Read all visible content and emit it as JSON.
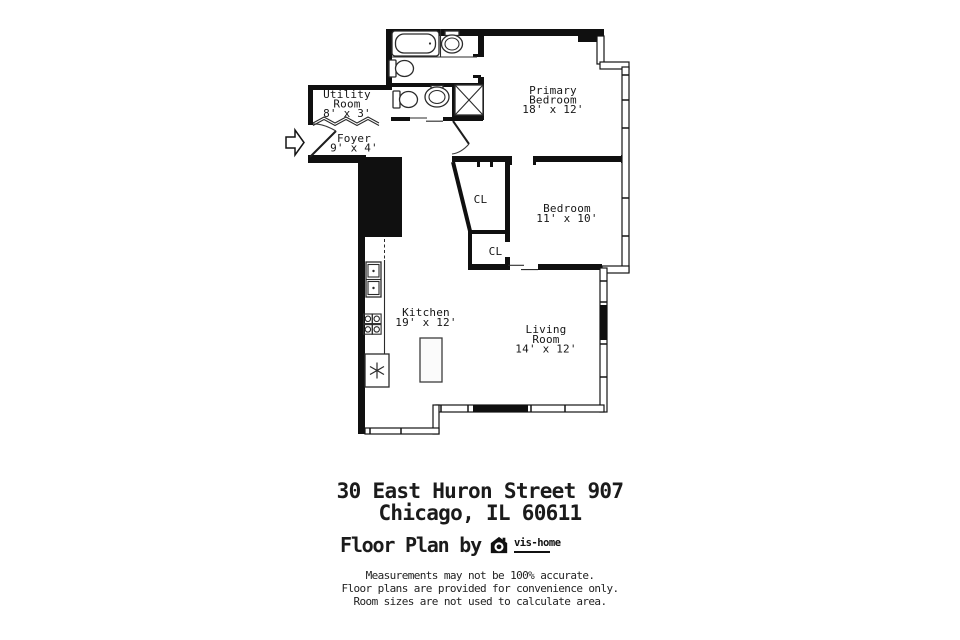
{
  "plan": {
    "rooms": {
      "utility": {
        "name_line1": "Utility",
        "name_line2": "Room",
        "dims": "8' x 3'"
      },
      "foyer": {
        "name": "Foyer",
        "dims": "9' x 4'"
      },
      "primary_bedroom": {
        "name_line1": "Primary",
        "name_line2": "Bedroom",
        "dims": "18' x 12'"
      },
      "bedroom": {
        "name": "Bedroom",
        "dims": "11' x 10'"
      },
      "kitchen": {
        "name": "Kitchen",
        "dims": "19' x 12'"
      },
      "living_room": {
        "name_line1": "Living",
        "name_line2": "Room",
        "dims": "14' x 12'"
      },
      "closet_upper": {
        "label": "CL"
      },
      "closet_lower": {
        "label": "CL"
      }
    },
    "colors": {
      "walls": "#111111",
      "background": "#ffffff"
    }
  },
  "footer": {
    "address_line1": "30 East Huron Street 907",
    "address_line2": "Chicago, IL 60611",
    "credit_text": "Floor Plan by",
    "logo_name": "vis-home",
    "disclaimer_line1": "Measurements may not be 100% accurate.",
    "disclaimer_line2": "Floor plans are provided for convenience only.",
    "disclaimer_line3": "Room sizes are not used to calculate area."
  }
}
